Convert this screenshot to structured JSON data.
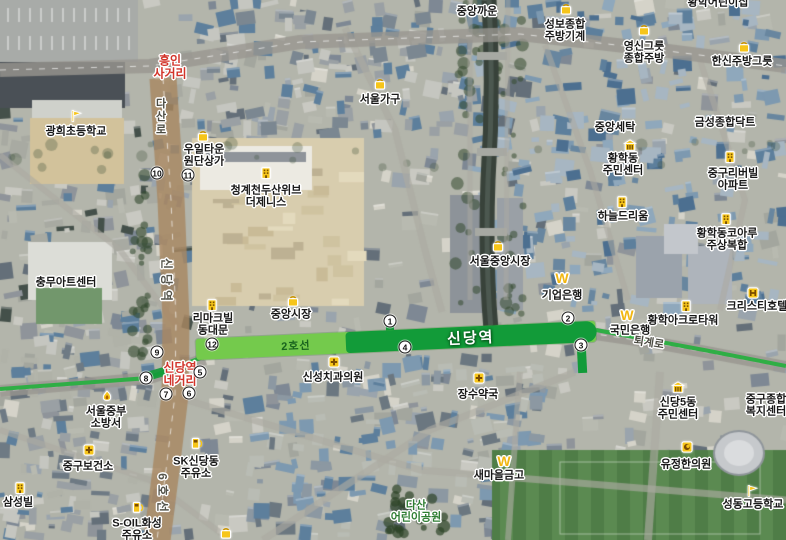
{
  "map": {
    "subway": {
      "line_label": "2호선",
      "station_label": "신당역",
      "line6_label": "6호선",
      "colors": {
        "line_light": "#74ca4c",
        "line_dark": "#129b39",
        "line_thin": "#2fae45",
        "exit_bg": "#ffffff"
      },
      "exits": [
        {
          "n": "1",
          "x": 390,
          "y": 321
        },
        {
          "n": "2",
          "x": 568,
          "y": 318
        },
        {
          "n": "3",
          "x": 581,
          "y": 345
        },
        {
          "n": "4",
          "x": 405,
          "y": 347
        },
        {
          "n": "5",
          "x": 200,
          "y": 372
        },
        {
          "n": "6",
          "x": 189,
          "y": 393
        },
        {
          "n": "7",
          "x": 166,
          "y": 394
        },
        {
          "n": "8",
          "x": 146,
          "y": 378
        },
        {
          "n": "9",
          "x": 157,
          "y": 352
        },
        {
          "n": "10",
          "x": 157,
          "y": 173
        },
        {
          "n": "11",
          "x": 188,
          "y": 175
        },
        {
          "n": "12",
          "x": 212,
          "y": 344
        }
      ]
    },
    "road_labels": [
      {
        "text": "다산로",
        "x": 160,
        "y": 117,
        "mode": "vertical"
      },
      {
        "text": "신당역",
        "x": 167,
        "y": 282,
        "mode": "rot90"
      },
      {
        "text": "6호선",
        "x": 163,
        "y": 495,
        "mode": "rot90"
      },
      {
        "text": "퇴계로",
        "x": 649,
        "y": 342,
        "mode": "rot8"
      }
    ],
    "intersections": [
      {
        "lines": [
          "흥인",
          "사거리"
        ],
        "x": 170,
        "y": 67
      },
      {
        "lines": [
          "신당역",
          "네거리"
        ],
        "x": 180,
        "y": 374
      }
    ],
    "parks": [
      {
        "lines": [
          "다산",
          "어린이공원"
        ],
        "x": 416,
        "y": 512
      }
    ],
    "pois": [
      {
        "lines": [
          "중앙까운"
        ],
        "x": 477,
        "y": 12,
        "icon": null
      },
      {
        "lines": [
          "황학어린이집"
        ],
        "x": 718,
        "y": 3,
        "icon": null
      },
      {
        "lines": [
          "성보종합",
          "주방기계"
        ],
        "x": 565,
        "y": 31,
        "icon": "shopping-bag-icon",
        "icon_x": 566,
        "icon_y": 9
      },
      {
        "lines": [
          "영신그릇",
          "종합주방"
        ],
        "x": 644,
        "y": 53,
        "icon": "shopping-bag-icon",
        "icon_x": 644,
        "icon_y": 30
      },
      {
        "lines": [
          "한신주방그릇"
        ],
        "x": 742,
        "y": 62,
        "icon": "shopping-bag-icon",
        "icon_x": 744,
        "icon_y": 47
      },
      {
        "lines": [
          "서울가구"
        ],
        "x": 380,
        "y": 100,
        "icon": "shopping-bag-icon",
        "icon_x": 380,
        "icon_y": 84
      },
      {
        "lines": [
          "광희초등학교"
        ],
        "x": 76,
        "y": 132,
        "icon": "school-flag-icon",
        "icon_x": 76,
        "icon_y": 116
      },
      {
        "lines": [
          "우일타운",
          "원단상가"
        ],
        "x": 204,
        "y": 156,
        "icon": "shopping-bag-icon",
        "icon_x": 203,
        "icon_y": 136
      },
      {
        "lines": [
          "청계천두산위브",
          "더제니스"
        ],
        "x": 266,
        "y": 197,
        "icon": "building-icon",
        "icon_x": 266,
        "icon_y": 173
      },
      {
        "lines": [
          "중앙세탁"
        ],
        "x": 615,
        "y": 128,
        "icon": null
      },
      {
        "lines": [
          "금성종합닥트"
        ],
        "x": 725,
        "y": 123,
        "icon": null
      },
      {
        "lines": [
          "황학동",
          "주민센터"
        ],
        "x": 623,
        "y": 165,
        "icon": "government-icon",
        "icon_x": 630,
        "icon_y": 145
      },
      {
        "lines": [
          "중구리버빌",
          "아파트"
        ],
        "x": 733,
        "y": 180,
        "icon": "building-icon",
        "icon_x": 730,
        "icon_y": 157
      },
      {
        "lines": [
          "하늘드리움"
        ],
        "x": 623,
        "y": 217,
        "icon": "building-icon",
        "icon_x": 622,
        "icon_y": 202
      },
      {
        "lines": [
          "황학동코아루",
          "주상복합"
        ],
        "x": 727,
        "y": 240,
        "icon": "building-icon",
        "icon_x": 726,
        "icon_y": 219
      },
      {
        "lines": [
          "서울중앙시장"
        ],
        "x": 500,
        "y": 262,
        "icon": "shopping-bag-icon",
        "icon_x": 498,
        "icon_y": 246
      },
      {
        "lines": [
          "충무아트센터"
        ],
        "x": 66,
        "y": 283,
        "icon": null
      },
      {
        "lines": [
          "기업은행"
        ],
        "x": 562,
        "y": 296,
        "icon": "won-icon",
        "icon_x": 562,
        "icon_y": 278
      },
      {
        "lines": [
          "리마크빌",
          "동대문"
        ],
        "x": 213,
        "y": 325,
        "icon": "building-icon",
        "icon_x": 212,
        "icon_y": 305
      },
      {
        "lines": [
          "중앙시장"
        ],
        "x": 291,
        "y": 315,
        "icon": "shopping-bag-icon",
        "icon_x": 293,
        "icon_y": 301
      },
      {
        "lines": [
          "국민은행"
        ],
        "x": 630,
        "y": 331,
        "icon": "won-icon",
        "icon_x": 627,
        "icon_y": 315
      },
      {
        "lines": [
          "황학아크로타워"
        ],
        "x": 683,
        "y": 321,
        "icon": "building-icon",
        "icon_x": 686,
        "icon_y": 306
      },
      {
        "lines": [
          "크리스티호텔"
        ],
        "x": 757,
        "y": 307,
        "icon": "hotel-icon",
        "icon_x": 753,
        "icon_y": 293
      },
      {
        "lines": [
          "신성치과의원"
        ],
        "x": 333,
        "y": 378,
        "icon": "medical-cross-icon",
        "icon_x": 334,
        "icon_y": 362
      },
      {
        "lines": [
          "장수약국"
        ],
        "x": 478,
        "y": 395,
        "icon": "medical-cross-icon",
        "icon_x": 479,
        "icon_y": 378
      },
      {
        "lines": [
          "서울중부",
          "소방서"
        ],
        "x": 106,
        "y": 418,
        "icon": "fire-station-icon",
        "icon_x": 107,
        "icon_y": 397
      },
      {
        "lines": [
          "중구보건소"
        ],
        "x": 88,
        "y": 467,
        "icon": "medical-cross-icon",
        "icon_x": 89,
        "icon_y": 450
      },
      {
        "lines": [
          "SK신당동",
          "주유소"
        ],
        "x": 196,
        "y": 468,
        "icon": "gas-station-icon",
        "icon_x": 197,
        "icon_y": 443
      },
      {
        "lines": [
          "삼성빌"
        ],
        "x": 18,
        "y": 503,
        "icon": "building-icon",
        "icon_x": 20,
        "icon_y": 488
      },
      {
        "lines": [
          "S-OIL화성",
          "주유소"
        ],
        "x": 137,
        "y": 530,
        "icon": "gas-station-icon",
        "icon_x": 138,
        "icon_y": 507
      },
      {
        "lines": [
          "새마을금고"
        ],
        "x": 499,
        "y": 476,
        "icon": "won-icon",
        "icon_x": 504,
        "icon_y": 461
      },
      {
        "lines": [
          "신당5동",
          "주민센터"
        ],
        "x": 678,
        "y": 409,
        "icon": "government-icon",
        "icon_x": 678,
        "icon_y": 387
      },
      {
        "lines": [
          "중구종합",
          "복지센터"
        ],
        "x": 766,
        "y": 406,
        "icon": null
      },
      {
        "lines": [
          "유정한의원"
        ],
        "x": 686,
        "y": 465,
        "icon": "clinic-icon",
        "icon_x": 687,
        "icon_y": 447
      },
      {
        "lines": [
          "성동고등학교"
        ],
        "x": 753,
        "y": 505,
        "icon": "school-flag-icon",
        "icon_x": 752,
        "icon_y": 491
      },
      {
        "lines": [],
        "x": 226,
        "y": 545,
        "icon": "shopping-bag-icon",
        "icon_x": 226,
        "icon_y": 533
      }
    ]
  }
}
